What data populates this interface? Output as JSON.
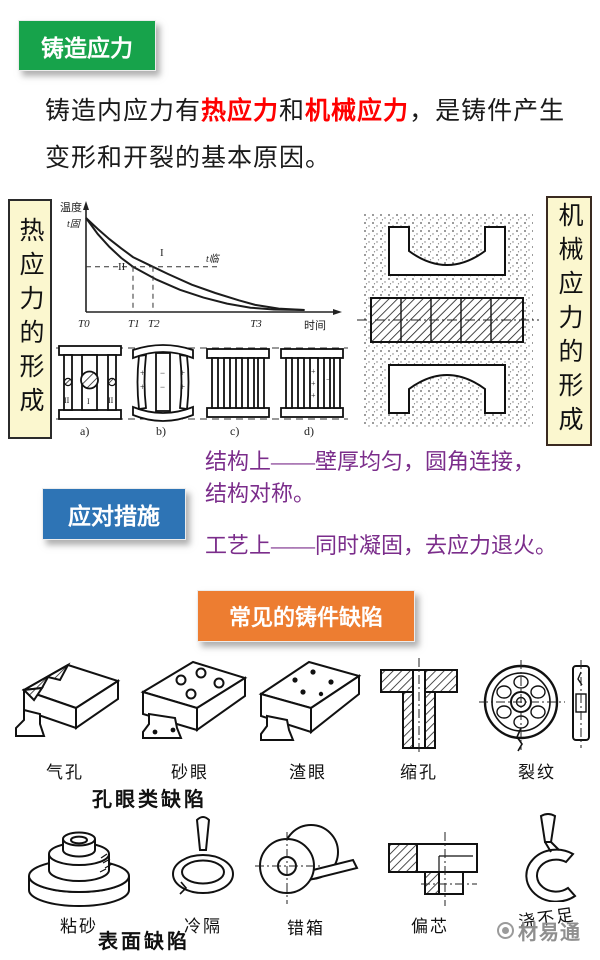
{
  "title_badge": {
    "label": "铸造应力",
    "bg": "#17A34B"
  },
  "intro": {
    "pre": "铸造内应力有",
    "hot": "热应力",
    "mid": "和",
    "mech": "机械应力",
    "post": "，是铸件产生变形和开裂的基本原因。",
    "highlight_color": "#FF0000"
  },
  "left_panel_label": "热应力的形成",
  "right_panel_label": "机械应力的形成",
  "panel_bg": "#FBF7CF",
  "chart_data": {
    "type": "line",
    "title": "铸件冷却曲线（厚壁 I 与薄壁 II）",
    "xlabel": "时间",
    "ylabel": "温度",
    "annotations": {
      "t_solid": "t固",
      "t_critical": "t临",
      "curve1": "I",
      "curve2": "II"
    },
    "x_ticks": [
      "T0",
      "T1",
      "T2",
      "T3"
    ],
    "series": [
      {
        "name": "I",
        "points": [
          [
            0,
            1
          ],
          [
            0.05,
            0.88
          ],
          [
            0.1,
            0.77
          ],
          [
            0.15,
            0.67
          ],
          [
            0.2,
            0.575
          ],
          [
            0.285,
            0.47
          ],
          [
            0.35,
            0.39
          ],
          [
            0.45,
            0.275
          ],
          [
            0.55,
            0.185
          ],
          [
            0.65,
            0.105
          ],
          [
            0.72,
            0.055
          ],
          [
            0.82,
            0.015
          ],
          [
            0.93,
            0
          ]
        ]
      },
      {
        "name": "II",
        "points": [
          [
            0,
            1
          ],
          [
            0.05,
            0.825
          ],
          [
            0.1,
            0.685
          ],
          [
            0.15,
            0.565
          ],
          [
            0.2,
            0.47
          ],
          [
            0.3,
            0.33
          ],
          [
            0.4,
            0.22
          ],
          [
            0.5,
            0.135
          ],
          [
            0.6,
            0.07
          ],
          [
            0.7,
            0.025
          ],
          [
            0.8,
            0.005
          ],
          [
            0.93,
            0
          ]
        ]
      }
    ],
    "guides": {
      "t_critical_level": 0.47,
      "t1_x": 0.2,
      "t2_x": 0.285,
      "t3_x": 0.72
    },
    "frames": [
      "a)",
      "b)",
      "c)",
      "d)"
    ],
    "frame_marks": [
      "II",
      "I",
      "II"
    ],
    "legend_position": "none",
    "grid": false
  },
  "countermeasures": {
    "badge": "应对措施",
    "badge_bg": "#2E74B5",
    "line1": "结构上——壁厚均匀，圆角连接，",
    "line2": "结构对称。",
    "line3": "工艺上——同时凝固，去应力退火。",
    "text_color": "#7B2D8B"
  },
  "defects_badge": {
    "label": "常见的铸件缺陷",
    "bg": "#ED7D31"
  },
  "defects": {
    "row1": {
      "items": [
        "气孔",
        "砂眼",
        "渣眼",
        "缩孔",
        "裂纹"
      ],
      "group": "孔眼类缺陷"
    },
    "row2": {
      "items": [
        "粘砂",
        "冷隔",
        "错箱",
        "偏芯",
        "浇不足"
      ],
      "group": "表面缺陷"
    }
  },
  "watermark": "材易通"
}
